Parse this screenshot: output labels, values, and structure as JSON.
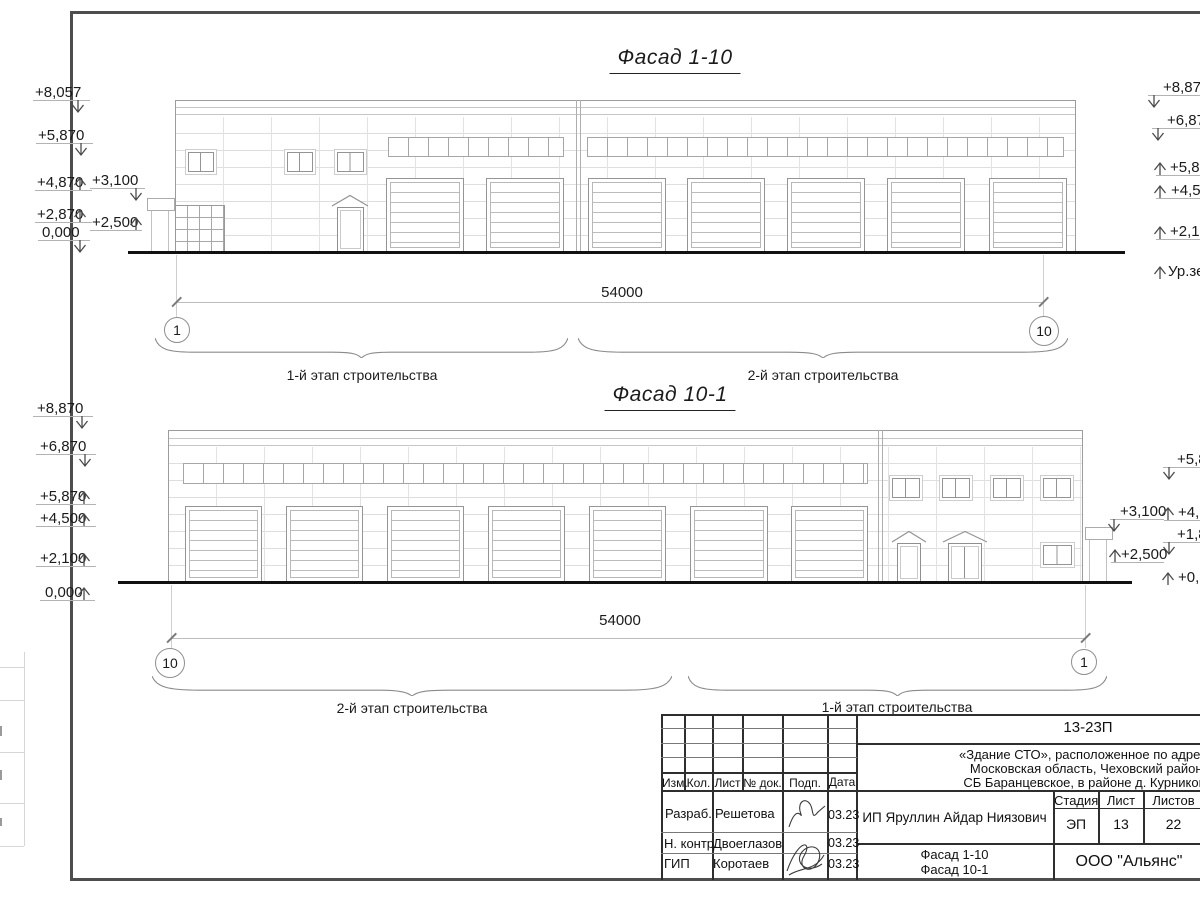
{
  "facade_top": {
    "title": "Фасад 1-10",
    "dimension": "54000",
    "axis_left": "1",
    "axis_right": "10",
    "stage_left": "1-й этап строительства",
    "stage_right": "2-й этап строительства",
    "marks_left": {
      "m1": "+8,057",
      "m2": "+5,870",
      "m3": "+4,870",
      "m4": "+2,870",
      "m5": "0,000"
    },
    "marks_canopy": {
      "m1": "+3,100",
      "m2": "+2,500"
    },
    "marks_right": {
      "m1": "+8,870",
      "m2": "+6,870",
      "m3": "+5,87",
      "m4": "+4,50",
      "m5": "+2,10",
      "m6": "Ур.зе"
    }
  },
  "facade_bottom": {
    "title": "Фасад 10-1",
    "dimension": "54000",
    "axis_left": "10",
    "axis_right": "1",
    "stage_left": "2-й этап строительства",
    "stage_right": "1-й этап строительства",
    "marks_left": {
      "m1": "+8,870",
      "m2": "+6,870",
      "m3": "+5,870",
      "m4": "+4,500",
      "m5": "+2,100",
      "m6": "0,000"
    },
    "marks_canopy": {
      "m1": "+3,100",
      "m2": "+2,500"
    },
    "marks_right": {
      "m1": "+5,8",
      "m2": "+4,8",
      "m3": "+1,8",
      "m4": "+0,8"
    }
  },
  "title_block": {
    "code": "13-23П",
    "project_line1": "«Здание СТО», расположенное по адресу:",
    "project_line2": "Московская область, Чеховский район,",
    "project_line3": "СБ Баранцевское, в районе д. Курниково",
    "cols": {
      "izm": "Изм.",
      "kol": "Кол.",
      "list": "Лист",
      "doc": "№ док.",
      "podp": "Подп.",
      "data": "Дата"
    },
    "rows": {
      "r1_role": "Разраб.",
      "r1_name": "Решетова",
      "r1_date": "03.23",
      "r2_role": "Н. контр.",
      "r2_name": "Двоеглазов",
      "r2_date": "03.23",
      "r3_role": "ГИП",
      "r3_name": "Коротаев",
      "r3_date": "03.23"
    },
    "client": "ИП Яруллин Айдар Ниязович",
    "stage_label": "Стадия",
    "sheet_label": "Лист",
    "sheets_label": "Листов",
    "stage_value": "ЭП",
    "sheet_value": "13",
    "sheets_value": "22",
    "doc_title_line1": "Фасад 1-10",
    "doc_title_line2": "Фасад 10-1",
    "company": "ООО \"Альянс\""
  }
}
